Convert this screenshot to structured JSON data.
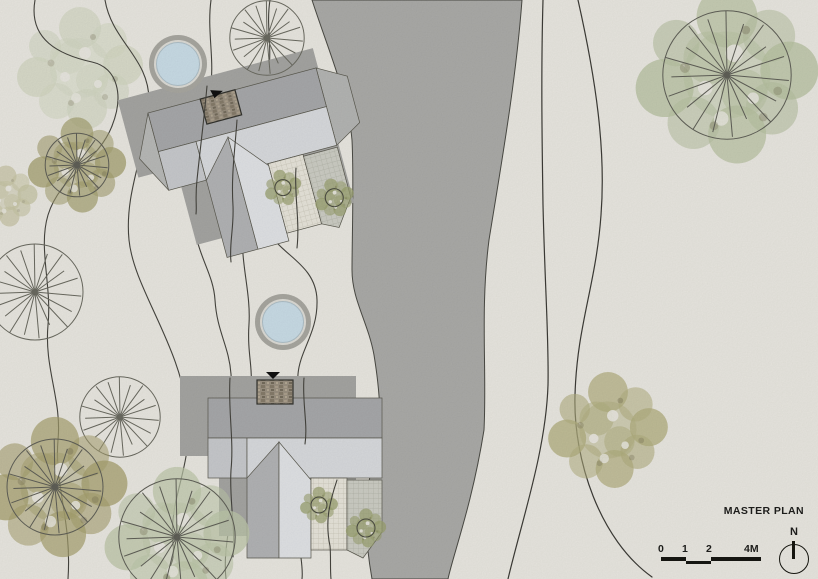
{
  "title": {
    "label": "MASTER PLAN"
  },
  "north_indicator": {
    "label": "N",
    "icon": "north-arrow-compass"
  },
  "scale_bar": {
    "ticks": [
      "0",
      "1",
      "2",
      "4M"
    ],
    "units": "meters"
  },
  "theme": {
    "bg": "#e9e7e0",
    "river": "#ababa8",
    "shadow": "#a5a5a2",
    "contour": "#45443e",
    "roof-dark": "#a7a8aa",
    "roof-light": "#d8dadd",
    "roof-mid": "#c7c9cc",
    "wing-left": "#b2b3b5",
    "wing-right": "#e0e2e5",
    "pool-water": "#c9dce6",
    "pool-rim": "#a8a7a0",
    "ink": "#1c1c1a"
  }
}
